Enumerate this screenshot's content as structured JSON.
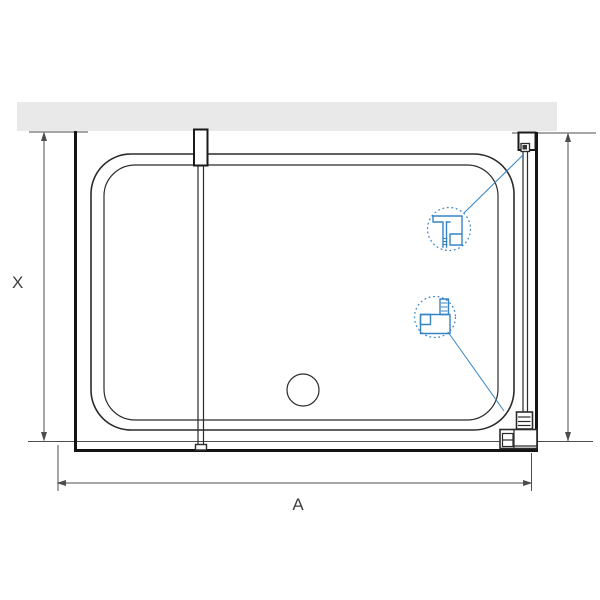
{
  "diagram": {
    "type": "technical-drawing",
    "subject": "shower enclosure top view with walk-in glass panel, shower tray, drain and wall profiles",
    "dimension_labels": {
      "depth_label": "X",
      "width_label": "A"
    },
    "colors": {
      "line": "#2b2b2b",
      "thick_line": "#141414",
      "dim_line": "#4d4d4d",
      "label_text": "#3f3f3f",
      "wall_fill": "#e9e9e9",
      "accent_blue": "#3584c6"
    }
  }
}
